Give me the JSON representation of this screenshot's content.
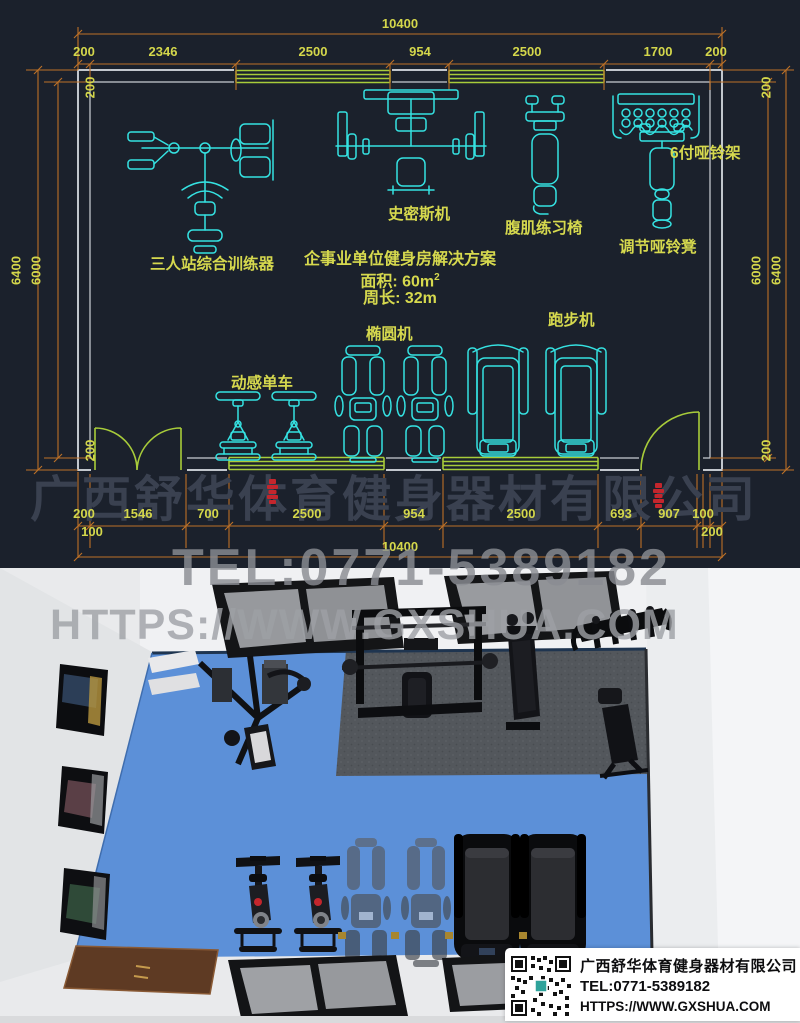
{
  "plan": {
    "solution": {
      "title": "企事业单位健身房解决方案",
      "area": "面积: 60m",
      "area_sup": "2",
      "perimeter": "周长: 32m"
    },
    "labels": {
      "multi_station": "三人站综合训练器",
      "smith_machine": "史密斯机",
      "ab_chair": "腹肌练习椅",
      "dumbbell_rack": "6付哑铃架",
      "dumbbell_bench": "调节哑铃凳",
      "elliptical": "椭圆机",
      "treadmill": "跑步机",
      "spin_bike": "动感单车"
    },
    "dims": {
      "top_total": "10400",
      "top_row": [
        "200",
        "2346",
        "2500",
        "954",
        "2500",
        "1700",
        "200"
      ],
      "bottom_row": [
        "200",
        "1546",
        "700",
        "2500",
        "954",
        "2500",
        "693",
        "907",
        "100"
      ],
      "bottom_sub_left": "100",
      "bottom_sub_right": "200",
      "bottom_total": "10400",
      "left": {
        "top": "200",
        "outer": "6400",
        "inner": "6000",
        "bottom": "200"
      },
      "right": {
        "top": "200",
        "inner": "6000",
        "outer": "6400",
        "bottom": "200"
      }
    }
  },
  "watermark": {
    "company": "广西舒华体育健身器材有限公司",
    "tel": "TEL:0771-5389182",
    "url": "HTTPS://WWW.GXSHUA.COM"
  },
  "info_card": {
    "company": "广西舒华体育健身器材有限公司",
    "tel": "TEL:0771-5389182",
    "url": "HTTPS://WWW.GXSHUA.COM"
  },
  "colors": {
    "cad_bg": "#1b212c",
    "equipment_cyan": "#35e2e2",
    "label_yellow": "#d4d74b",
    "dim_orange": "#bd7127",
    "window_green": "#a8cc3a",
    "wall_gray": "#c2c7cd",
    "logo_red": "#c4262d",
    "floor_blue": "#5c90d8",
    "mat_gray": "#53575c",
    "render_bg": "#e9eaec"
  }
}
